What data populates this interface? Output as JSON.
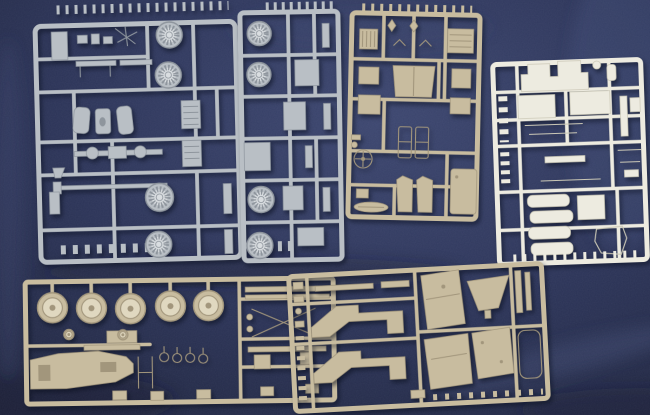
{
  "meta": {
    "description": "Photograph of six injection-molded plastic model kit sprues (parts trees) in light gray, tan and off-white plastic, laid out on a dark navy fabric background"
  },
  "colors": {
    "fabric_base": "#2c3458",
    "fabric_light": "#46507c",
    "fabric_dark": "#1d2340",
    "gray_plastic": "#b9bfc5",
    "gray_plastic_light": "#d9dde0",
    "gray_plastic_dark": "#8e959d",
    "tan_plastic": "#c8bc9f",
    "tan_plastic_light": "#e0d8c0",
    "tan_plastic_dark": "#a2967c",
    "white_plastic": "#edebe0",
    "white_plastic_light": "#f8f7f1",
    "white_plastic_dark": "#cbc8b6"
  },
  "sprues": [
    {
      "id": "gray-left",
      "plastic": "gray",
      "contents": "small fittings, axles, hatched panels, rods and four spoked wheels"
    },
    {
      "id": "gray-right",
      "plastic": "gray",
      "contents": "four spoked wheels, rectangular panels and rows of small pins"
    },
    {
      "id": "tan-top-middle",
      "plastic": "tan",
      "contents": "grille, bench seat back, doors, windshield frames, steering wheel and oval plate"
    },
    {
      "id": "white-top-right",
      "plastic": "white",
      "contents": "cowl piece, flat body panels, four cushion/tank bars and an outline frame"
    },
    {
      "id": "tan-bottom-left",
      "plastic": "tan",
      "contents": "five disc road wheels, tapered chassis piece, rings and cross braces"
    },
    {
      "id": "tan-bottom-right",
      "plastic": "tan",
      "contents": "two stepped running-board panels, hood, funnel fender and large flat body panels"
    }
  ],
  "wheels": {
    "gray_left": [
      {
        "cx": 172,
        "cy": 36,
        "r": 13
      },
      {
        "cx": 170,
        "cy": 76,
        "r": 13
      },
      {
        "cx": 158,
        "cy": 198,
        "r": 14
      },
      {
        "cx": 156,
        "cy": 245,
        "r": 13
      }
    ],
    "gray_right": [
      {
        "cx": 261,
        "cy": 33,
        "r": 12
      },
      {
        "cx": 260,
        "cy": 74,
        "r": 12
      },
      {
        "cx": 260,
        "cy": 199,
        "r": 13
      },
      {
        "cx": 258,
        "cy": 245,
        "r": 13
      }
    ],
    "tan_disc": [
      {
        "cx": 53,
        "cy": 306,
        "r": 15
      },
      {
        "cx": 92,
        "cy": 307,
        "r": 15
      },
      {
        "cx": 131,
        "cy": 308,
        "r": 15
      },
      {
        "cx": 171,
        "cy": 306,
        "r": 15
      },
      {
        "cx": 209,
        "cy": 306,
        "r": 15
      }
    ],
    "tan_small": [
      {
        "cx": 69,
        "cy": 333,
        "r": 5
      },
      {
        "cx": 123,
        "cy": 334,
        "r": 5
      }
    ]
  }
}
